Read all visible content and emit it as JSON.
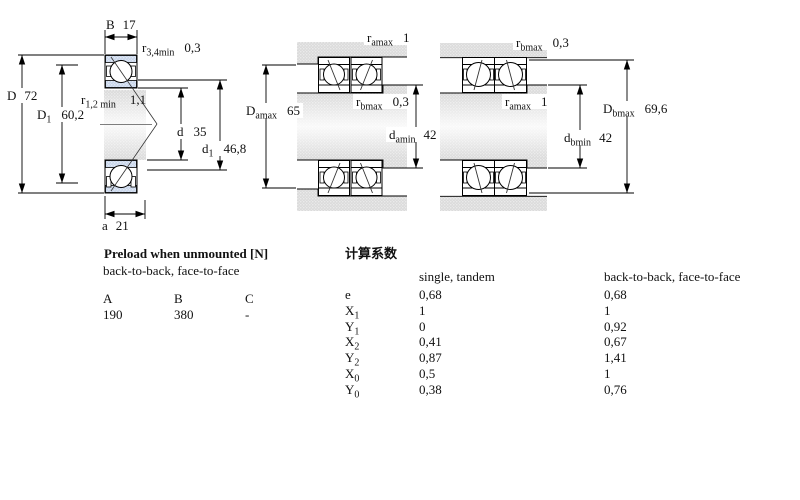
{
  "diagram": {
    "left": {
      "dim_B": {
        "base": "B",
        "value": "17"
      },
      "dim_r34": {
        "base": "r",
        "sub": "3,4min",
        "value": "0,3"
      },
      "dim_D": {
        "base": "D",
        "value": "72"
      },
      "dim_D1": {
        "base": "D",
        "sub": "1",
        "value": "60,2"
      },
      "dim_r12": {
        "base": "r",
        "sub": "1,2 min",
        "value": "1,1"
      },
      "dim_d": {
        "base": "d",
        "value": "35"
      },
      "dim_d1": {
        "base": "d",
        "sub": "1",
        "value": "46,8"
      },
      "dim_a": {
        "base": "a",
        "value": "21"
      }
    },
    "middle": {
      "dim_ramax": {
        "base": "r",
        "sub": "amax",
        "value": "1"
      },
      "dim_Damax": {
        "base": "D",
        "sub": "amax",
        "value": "65"
      },
      "dim_rbmax": {
        "base": "r",
        "sub": "bmax",
        "value": "0,3"
      },
      "dim_damin": {
        "base": "d",
        "sub": "amin",
        "value": "42"
      }
    },
    "right": {
      "dim_rbmax": {
        "base": "r",
        "sub": "bmax",
        "value": "0,3"
      },
      "dim_ramax": {
        "base": "r",
        "sub": "amax",
        "value": "1"
      },
      "dim_Dbmax": {
        "base": "D",
        "sub": "bmax",
        "value": "69,6"
      },
      "dim_dbmin": {
        "base": "d",
        "sub": "bmin",
        "value": "42"
      }
    }
  },
  "preload_table": {
    "title": "Preload when unmounted [N]",
    "subtitle": "back-to-back, face-to-face",
    "columns": [
      "A",
      "B",
      "C"
    ],
    "values": [
      "190",
      "380",
      "-"
    ]
  },
  "factors_table": {
    "title": "计算系数",
    "col1_header": "single, tandem",
    "col2_header": "back-to-back, face-to-face",
    "rows": [
      {
        "label": "e",
        "sub": "",
        "v1": "0,68",
        "v2": "0,68"
      },
      {
        "label": "X",
        "sub": "1",
        "v1": "1",
        "v2": "1"
      },
      {
        "label": "Y",
        "sub": "1",
        "v1": "0",
        "v2": "0,92"
      },
      {
        "label": "X",
        "sub": "2",
        "v1": "0,41",
        "v2": "0,67"
      },
      {
        "label": "Y",
        "sub": "2",
        "v1": "0,87",
        "v2": "1,41"
      },
      {
        "label": "X",
        "sub": "0",
        "v1": "0,5",
        "v2": "1"
      },
      {
        "label": "Y",
        "sub": "0",
        "v1": "0,38",
        "v2": "0,76"
      }
    ]
  }
}
